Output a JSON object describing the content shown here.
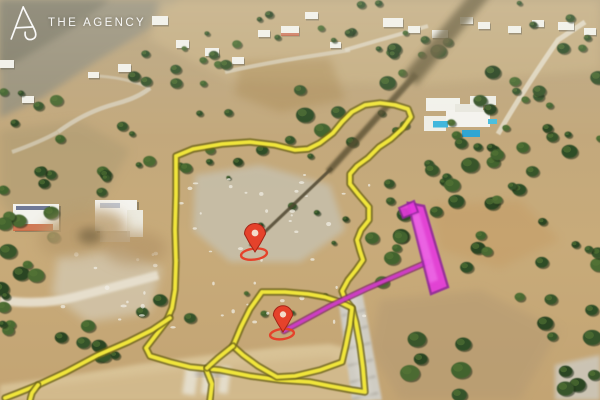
{
  "brand": {
    "name": "THE AGENCY",
    "logo_icon": "agency-a-monogram"
  },
  "annotations": {
    "boundary_color": "#f0e53a",
    "boundary_halo": "#6d6418",
    "main_parcel": [
      [
        176,
        156
      ],
      [
        193,
        149
      ],
      [
        222,
        144
      ],
      [
        250,
        142
      ],
      [
        275,
        145
      ],
      [
        295,
        150
      ],
      [
        308,
        149
      ],
      [
        320,
        143
      ],
      [
        333,
        133
      ],
      [
        342,
        122
      ],
      [
        352,
        112
      ],
      [
        365,
        105
      ],
      [
        380,
        103
      ],
      [
        395,
        105
      ],
      [
        408,
        109
      ],
      [
        411,
        117
      ],
      [
        403,
        128
      ],
      [
        391,
        139
      ],
      [
        379,
        147
      ],
      [
        368,
        158
      ],
      [
        357,
        166
      ],
      [
        350,
        174
      ],
      [
        350,
        184
      ],
      [
        358,
        194
      ],
      [
        369,
        207
      ],
      [
        369,
        220
      ],
      [
        361,
        230
      ],
      [
        357,
        240
      ],
      [
        360,
        251
      ],
      [
        363,
        260
      ],
      [
        356,
        270
      ],
      [
        348,
        280
      ],
      [
        342,
        291
      ],
      [
        345,
        299
      ],
      [
        352,
        308
      ],
      [
        356,
        323
      ],
      [
        360,
        345
      ],
      [
        363,
        368
      ],
      [
        365,
        392
      ],
      [
        352,
        390
      ],
      [
        330,
        386
      ],
      [
        310,
        382
      ],
      [
        280,
        380
      ],
      [
        250,
        376
      ],
      [
        220,
        370
      ],
      [
        190,
        367
      ],
      [
        170,
        362
      ],
      [
        150,
        356
      ],
      [
        146,
        348
      ],
      [
        156,
        335
      ],
      [
        166,
        322
      ],
      [
        172,
        308
      ],
      [
        175,
        290
      ],
      [
        176,
        262
      ],
      [
        175,
        230
      ],
      [
        176,
        195
      ],
      [
        176,
        156
      ]
    ],
    "inner_parcel": [
      [
        262,
        292
      ],
      [
        285,
        292
      ],
      [
        308,
        294
      ],
      [
        325,
        297
      ],
      [
        340,
        302
      ],
      [
        352,
        308
      ],
      [
        350,
        325
      ],
      [
        346,
        345
      ],
      [
        342,
        362
      ],
      [
        320,
        370
      ],
      [
        295,
        376
      ],
      [
        277,
        377
      ],
      [
        258,
        366
      ],
      [
        243,
        355
      ],
      [
        233,
        346
      ],
      [
        241,
        327
      ],
      [
        250,
        309
      ],
      [
        262,
        292
      ]
    ],
    "roadside_line": [
      [
        170,
        318
      ],
      [
        152,
        330
      ],
      [
        128,
        342
      ],
      [
        98,
        355
      ],
      [
        66,
        372
      ],
      [
        38,
        385
      ],
      [
        18,
        393
      ],
      [
        5,
        398
      ]
    ],
    "roadside_fork": [
      [
        38,
        385
      ],
      [
        32,
        393
      ],
      [
        30,
        400
      ]
    ],
    "spur": [
      [
        206,
        369
      ],
      [
        212,
        384
      ],
      [
        210,
        400
      ]
    ],
    "connector": [
      [
        233,
        346
      ],
      [
        218,
        358
      ],
      [
        207,
        368
      ]
    ],
    "highlight_strip": {
      "points": [
        [
          408,
          203
        ],
        [
          424,
          206
        ],
        [
          448,
          287
        ],
        [
          431,
          294
        ]
      ],
      "cap": [
        [
          399,
          208
        ],
        [
          414,
          201
        ],
        [
          418,
          212
        ],
        [
          403,
          218
        ]
      ],
      "color": "#e538dd",
      "edge": "#92279c"
    },
    "access_line": {
      "points": [
        [
          284,
          331
        ],
        [
          330,
          306
        ],
        [
          368,
          288
        ],
        [
          428,
          262
        ]
      ],
      "color": "#cc3ec2",
      "edge": "#7e2a66"
    },
    "markers": [
      {
        "x": 255,
        "y": 252
      },
      {
        "x": 283,
        "y": 332
      }
    ],
    "marker_color": "#e5422b",
    "marker_edge": "#a32517"
  }
}
